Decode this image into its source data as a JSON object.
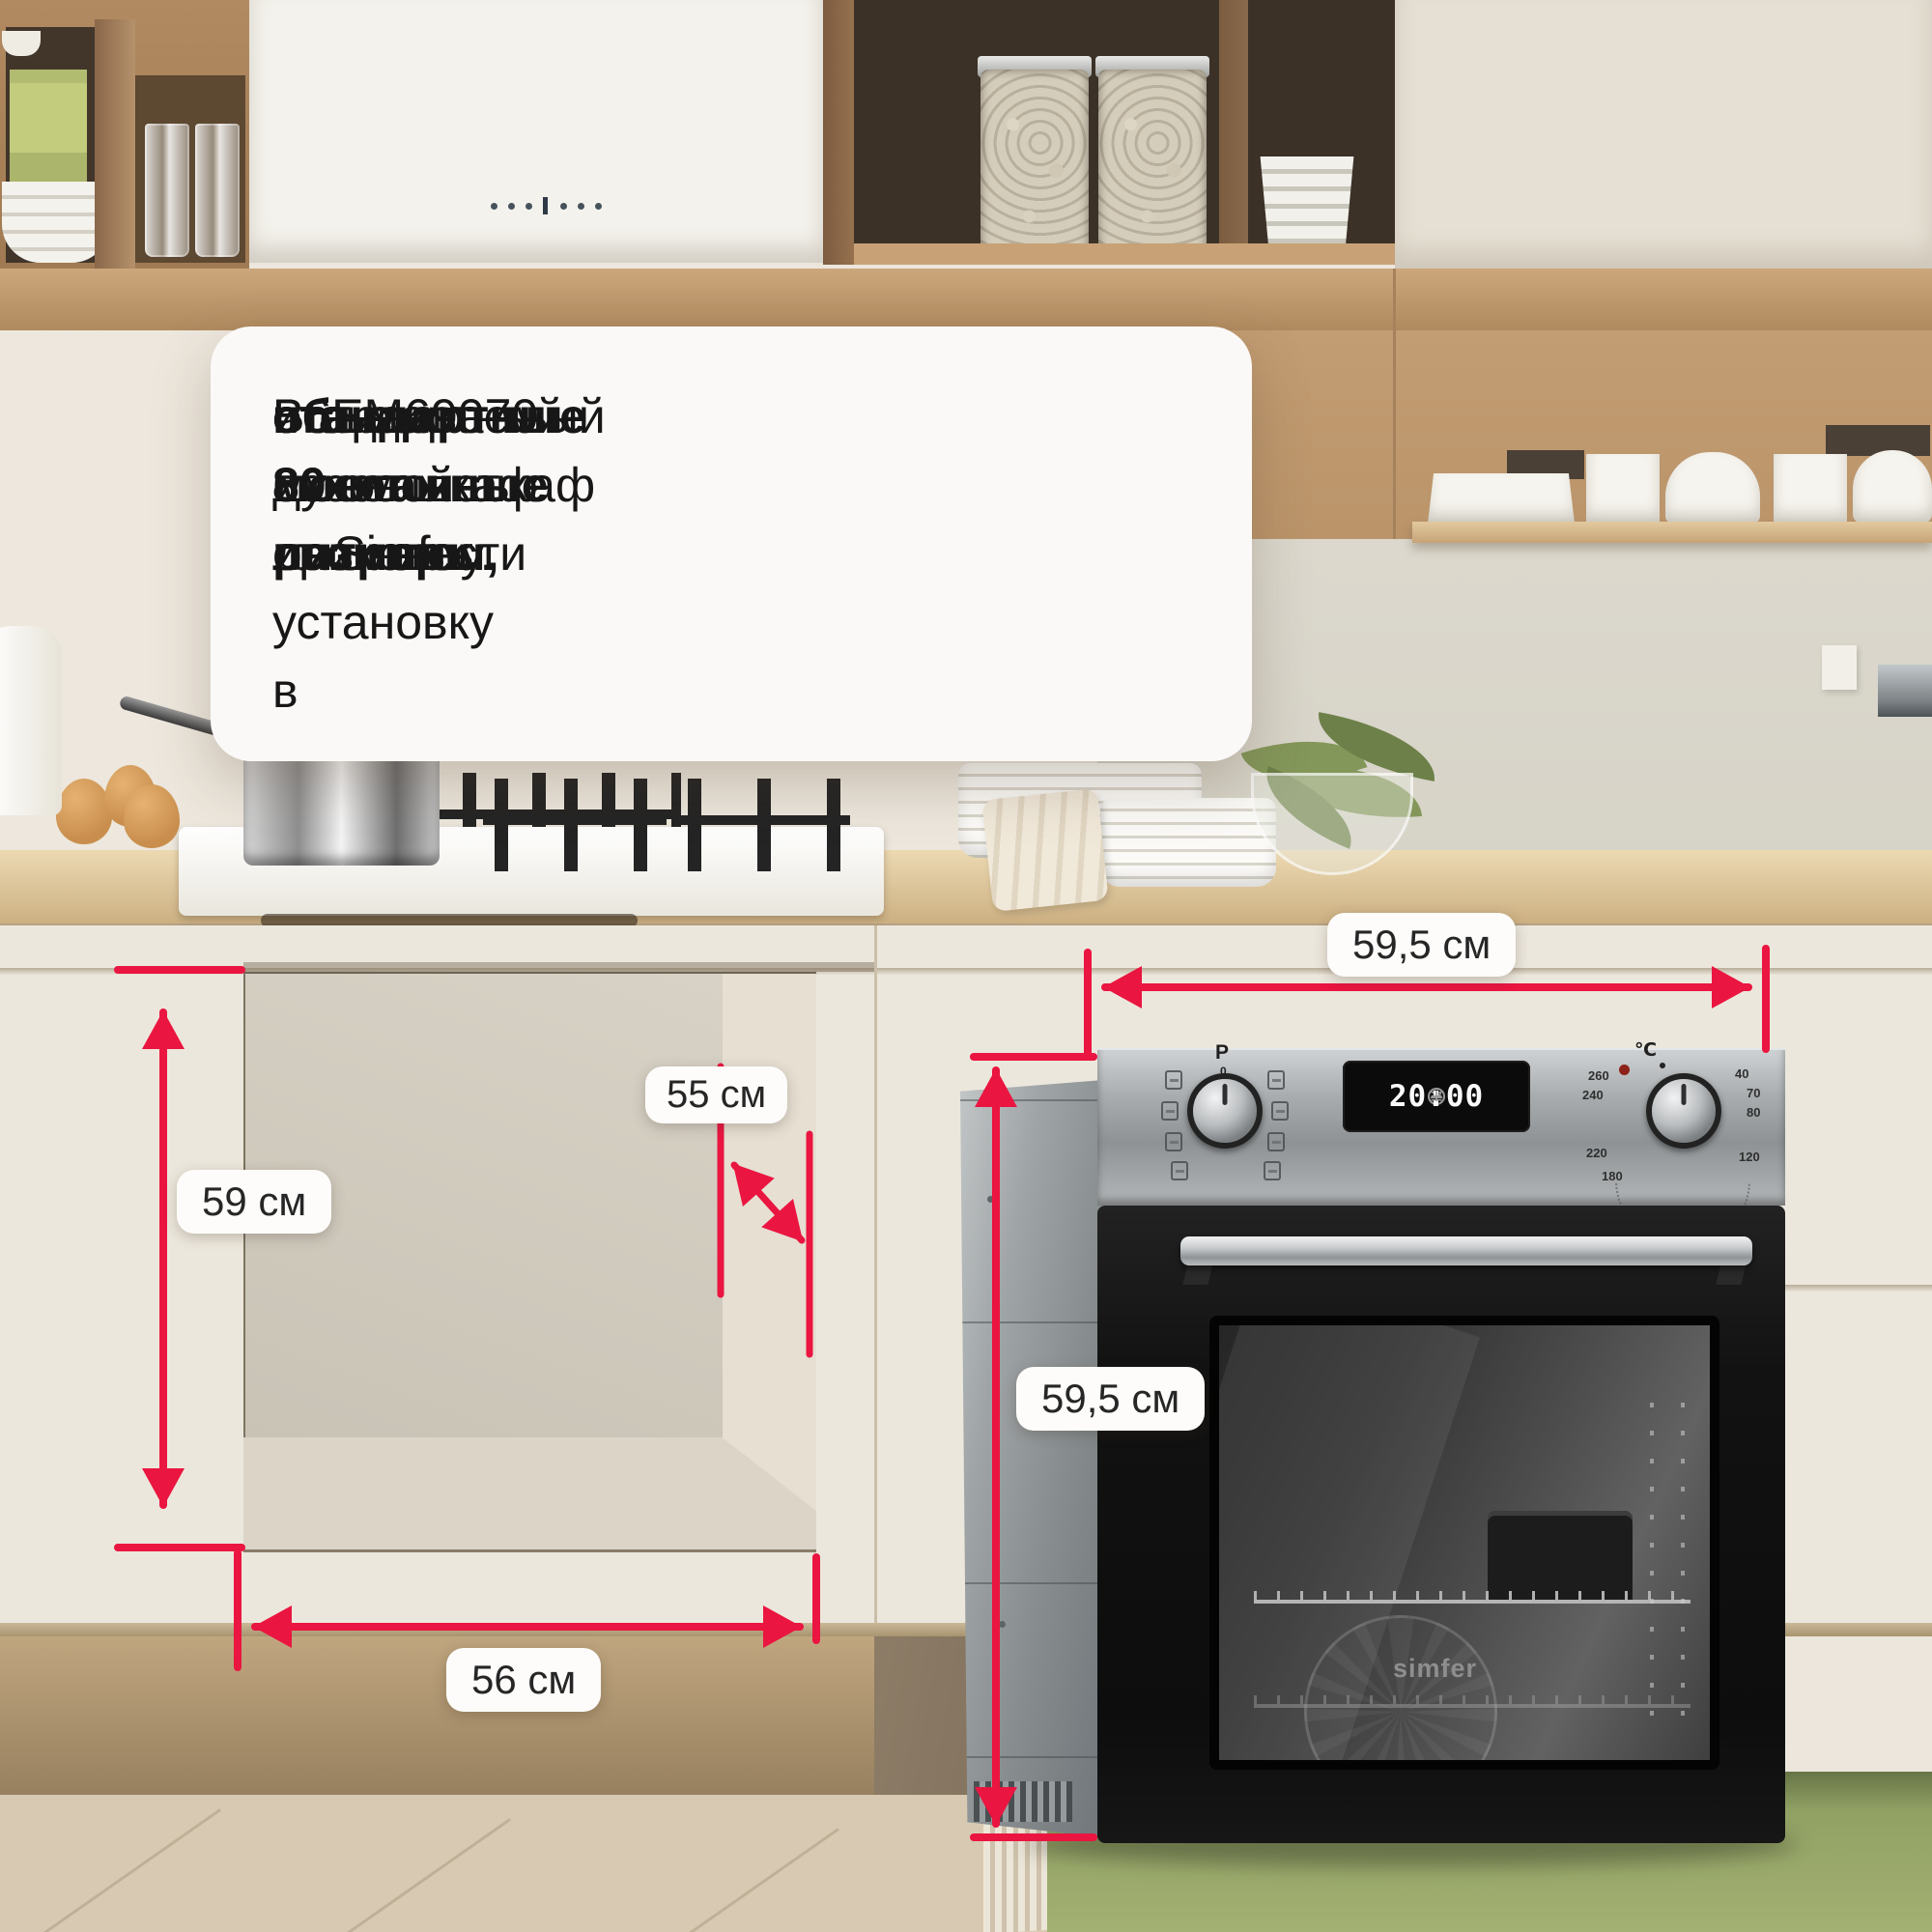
{
  "colors": {
    "accent_red": "#ea1540",
    "pill_background": "#fdfcfa",
    "text_dark": "#171717"
  },
  "description": {
    "line1": "Встраиваемый духовой шкаф от Simfer",
    "line2_regular": "B6EM69070 имеет ",
    "line2_bold": "объем 80 литров",
    "line2_tail": " и",
    "line3_bold": "стандартные монтажные размеры,",
    "line4": "что позволяет произвести установку в",
    "line5": "стандартный 60 см шкаф или нишу."
  },
  "dimensions": {
    "niche_height": "59 см",
    "niche_depth": "55 см",
    "niche_width": "56 см",
    "oven_width": "59,5 см",
    "oven_height": "59,5 см"
  },
  "oven": {
    "brand_logo": "simfer",
    "knob_left_label": "P",
    "knob_left_zero": "0",
    "temp_unit": "℃",
    "display": {
      "menu_icon": "≡",
      "time": "20:00",
      "minus": "–",
      "plus": "+"
    },
    "temps": [
      "40",
      "70",
      "80",
      "120",
      "180",
      "220",
      "240",
      "260"
    ]
  }
}
